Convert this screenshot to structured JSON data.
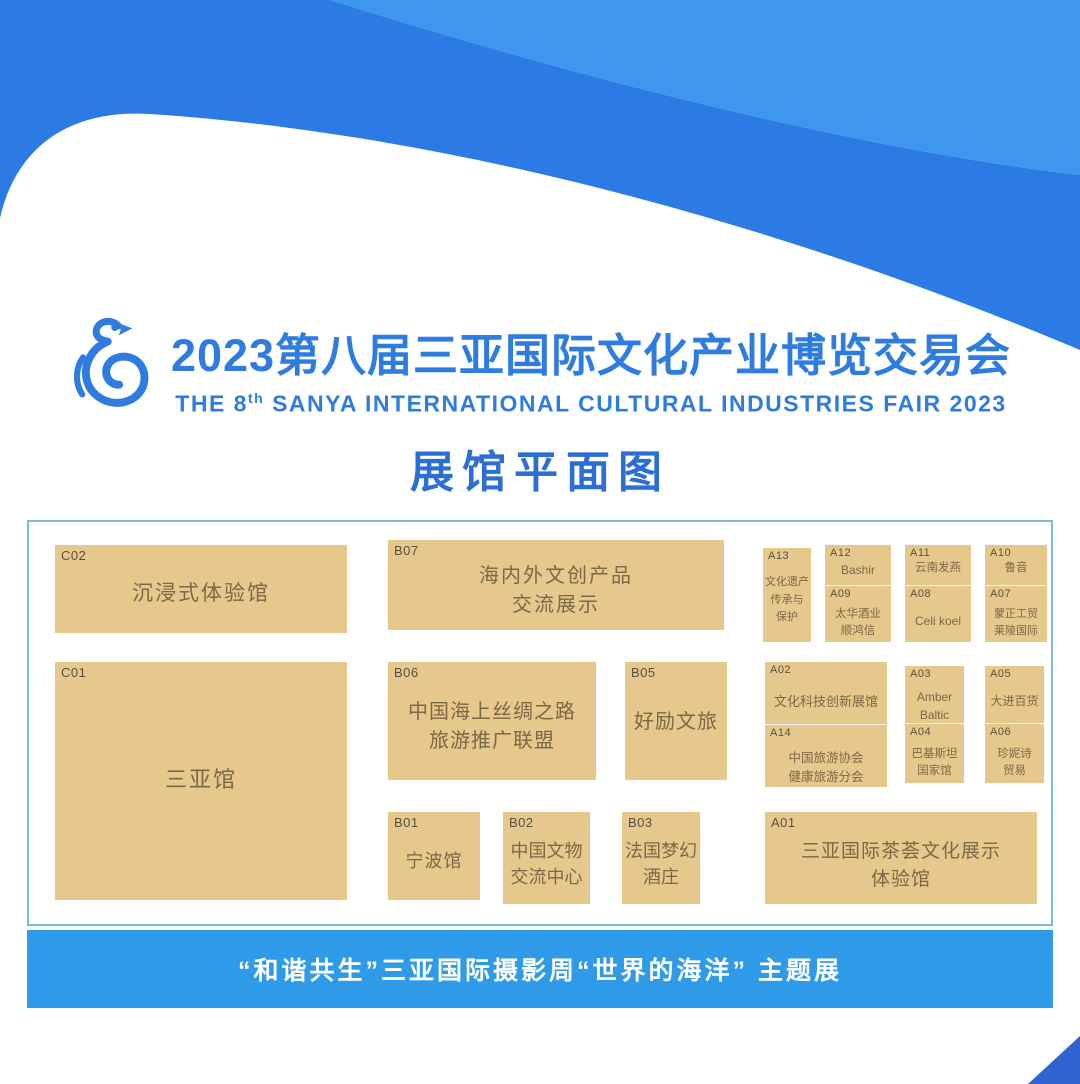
{
  "header": {
    "title_cn": "2023第八届三亚国际文化产业博览交易会",
    "title_en_pre": "THE 8",
    "title_en_sup": "th",
    "title_en_rest": " SANYA INTERNATIONAL CULTURAL INDUSTRIES FAIR 2023",
    "logo": "blue-phoenix-bird"
  },
  "plan_heading": "展馆平面图",
  "booths": {
    "c02": {
      "code": "C02",
      "name": "沉浸式体验馆"
    },
    "c01": {
      "code": "C01",
      "name": "三亚馆"
    },
    "b07": {
      "code": "B07",
      "name": "海内外文创产品\n交流展示"
    },
    "b06": {
      "code": "B06",
      "name": "中国海上丝绸之路\n旅游推广联盟"
    },
    "b05": {
      "code": "B05",
      "name": "好励文旅"
    },
    "b01": {
      "code": "B01",
      "name": "宁波馆"
    },
    "b02": {
      "code": "B02",
      "name": "中国文物\n交流中心"
    },
    "b03": {
      "code": "B03",
      "name": "法国梦幻\n酒庄"
    },
    "a01": {
      "code": "A01",
      "name": "三亚国际茶荟文化展示\n体验馆"
    },
    "a13": {
      "code": "A13",
      "name": "文化遗产\n传承与\n保护"
    },
    "a12": {
      "code": "A12",
      "name": "Bashir"
    },
    "a09": {
      "code": "A09",
      "name": "太华酒业\n顺鸿信"
    },
    "a11": {
      "code": "A11",
      "name": "云南发燕"
    },
    "a08": {
      "code": "A08",
      "name": "Celi koel"
    },
    "a10": {
      "code": "A10",
      "name": "鲁音"
    },
    "a07": {
      "code": "A07",
      "name": "蒙正工贸\n莱陵国际"
    },
    "a02": {
      "code": "A02",
      "name": "文化科技创新展馆"
    },
    "a14": {
      "code": "A14",
      "name": "中国旅游协会\n健康旅游分会"
    },
    "a03": {
      "code": "A03",
      "name": "Amber\nBaltic"
    },
    "a04": {
      "code": "A04",
      "name": "巴基斯坦\n国家馆"
    },
    "a05": {
      "code": "A05",
      "name": "大进百货"
    },
    "a06": {
      "code": "A06",
      "name": "珍妮诗\n贸易"
    }
  },
  "footer": {
    "text": "“和谐共生”三亚国际摄影周“世界的海洋” 主题展"
  },
  "colors": {
    "light_blue": "#3e96ef",
    "dark_blue": "#2c7be5",
    "title_blue": "#2e7ce0",
    "heading_blue": "#2b6fd4",
    "footer_blue": "#2f9ae8",
    "corner_blue": "#2f63cf",
    "booth_fill": "#e6c88d",
    "booth_text": "#7b6848",
    "plan_border": "#7cb9d2"
  }
}
